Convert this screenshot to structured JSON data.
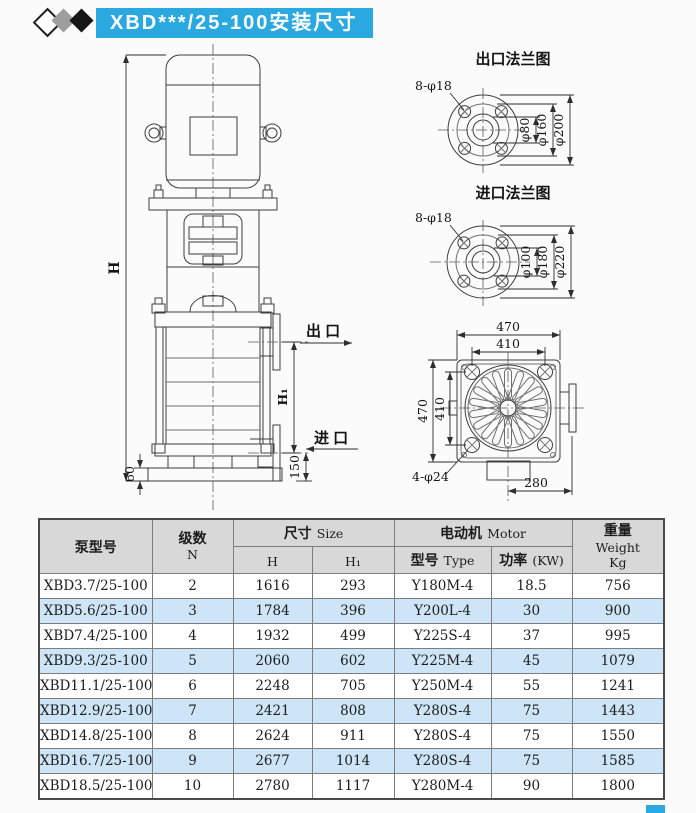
{
  "titlebar": {
    "title": "XBD***/25-100安装尺寸",
    "banner_color": "#29a9e0"
  },
  "pump_drawing": {
    "dim_h": "H",
    "dim_h1": "H₁",
    "dim_150": "150",
    "dim_60": "60",
    "outlet_label": "出 口",
    "inlet_label": "进 口"
  },
  "outlet_flange": {
    "title": "出口法兰图",
    "bolts": "8-φ18",
    "dia_inner": "φ80",
    "dia_bolt": "φ160",
    "dia_outer": "φ200"
  },
  "inlet_flange": {
    "title": "进口法兰图",
    "bolts": "8-φ18",
    "dia_inner": "φ100",
    "dia_bolt": "φ180",
    "dia_outer": "φ220"
  },
  "base_drawing": {
    "dim_top_outer": "470",
    "dim_top_inner": "410",
    "dim_left_outer": "470",
    "dim_left_inner": "410",
    "bolts": "4-φ24",
    "dim_bottom": "280"
  },
  "table": {
    "header": {
      "model": "泵型号",
      "stages_cn": "级数",
      "stages_en": "N",
      "size_cn": "尺寸",
      "size_en": "Size",
      "col_h": "H",
      "col_h1": "H₁",
      "motor_cn": "电动机",
      "motor_en": "Motor",
      "type_cn": "型号",
      "type_en": "Type",
      "power_cn": "功率",
      "power_unit": "(KW)",
      "weight_cn": "重量",
      "weight_en": "Weight",
      "weight_unit": "Kg"
    },
    "rows": [
      {
        "model": "XBD3.7/25-100",
        "n": "2",
        "h": "1616",
        "h1": "293",
        "type": "Y180M-4",
        "kw": "18.5",
        "kg": "756"
      },
      {
        "model": "XBD5.6/25-100",
        "n": "3",
        "h": "1784",
        "h1": "396",
        "type": "Y200L-4",
        "kw": "30",
        "kg": "900"
      },
      {
        "model": "XBD7.4/25-100",
        "n": "4",
        "h": "1932",
        "h1": "499",
        "type": "Y225S-4",
        "kw": "37",
        "kg": "995"
      },
      {
        "model": "XBD9.3/25-100",
        "n": "5",
        "h": "2060",
        "h1": "602",
        "type": "Y225M-4",
        "kw": "45",
        "kg": "1079"
      },
      {
        "model": "XBD11.1/25-100",
        "n": "6",
        "h": "2248",
        "h1": "705",
        "type": "Y250M-4",
        "kw": "55",
        "kg": "1241"
      },
      {
        "model": "XBD12.9/25-100",
        "n": "7",
        "h": "2421",
        "h1": "808",
        "type": "Y280S-4",
        "kw": "75",
        "kg": "1443"
      },
      {
        "model": "XBD14.8/25-100",
        "n": "8",
        "h": "2624",
        "h1": "911",
        "type": "Y280S-4",
        "kw": "75",
        "kg": "1550"
      },
      {
        "model": "XBD16.7/25-100",
        "n": "9",
        "h": "2677",
        "h1": "1014",
        "type": "Y280S-4",
        "kw": "75",
        "kg": "1585"
      },
      {
        "model": "XBD18.5/25-100",
        "n": "10",
        "h": "2780",
        "h1": "1117",
        "type": "Y280M-4",
        "kw": "90",
        "kg": "1800"
      }
    ]
  }
}
